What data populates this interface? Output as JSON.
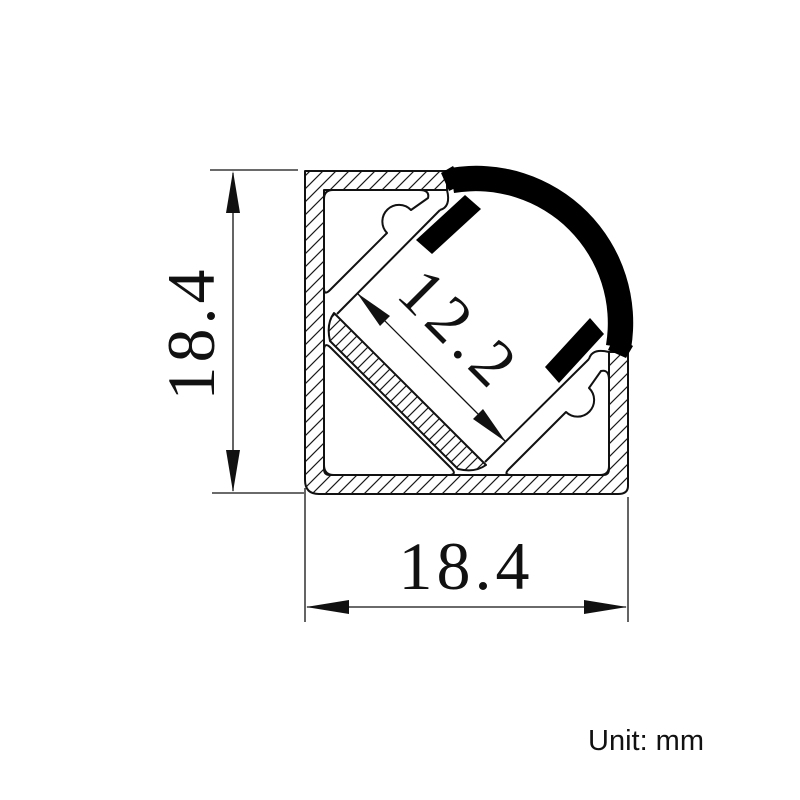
{
  "diagram": {
    "dimension_labels": {
      "height_mm": "18.4",
      "width_mm": "18.4",
      "channel_mm": "12.2"
    },
    "unit_note": "Unit: mm",
    "colors": {
      "line": "#111111",
      "cover_fill": "#000000",
      "background": "#ffffff"
    }
  }
}
